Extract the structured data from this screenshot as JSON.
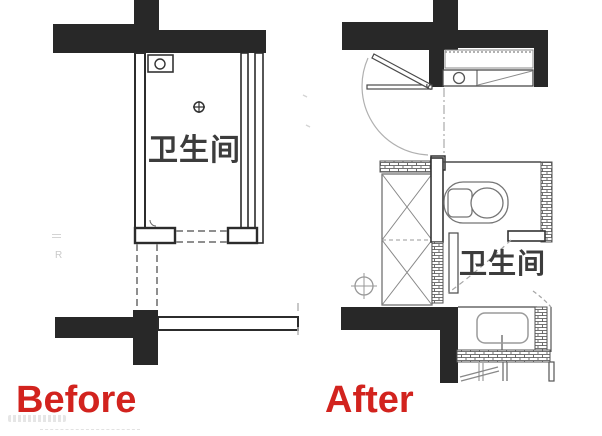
{
  "image": {
    "width": 602,
    "height": 436,
    "background": "#ffffff",
    "description": "Bathroom floor plan comparison, before and after renovation"
  },
  "panels": {
    "before": {
      "caption": "Before",
      "room_label": "卫生间"
    },
    "after": {
      "caption": "After",
      "room_label": "卫生间"
    }
  },
  "annotations": {
    "left_margin_letter": "R"
  },
  "colors": {
    "wall_fill": "#282828",
    "line_dark": "#4a4a4a",
    "line_medium": "#777777",
    "line_light": "#aaaaaa",
    "hatch_line": "#5f5f5f",
    "room_label": "#3c3c3c",
    "caption_red": "#d2231e",
    "watermark_gray": "#c9c9c9"
  },
  "icons": {
    "floor_drain": "circle-with-crosshair",
    "vent_box": "small-box-with-circle",
    "toilet": "tank-and-bowl-plan-symbol",
    "sink": "rounded-basin-with-faucet",
    "washer_counter": "counter-with-circle-and-diagonal",
    "shower_storage": "crossed-box",
    "door_swing": "quarter-arc-with-leaf"
  }
}
